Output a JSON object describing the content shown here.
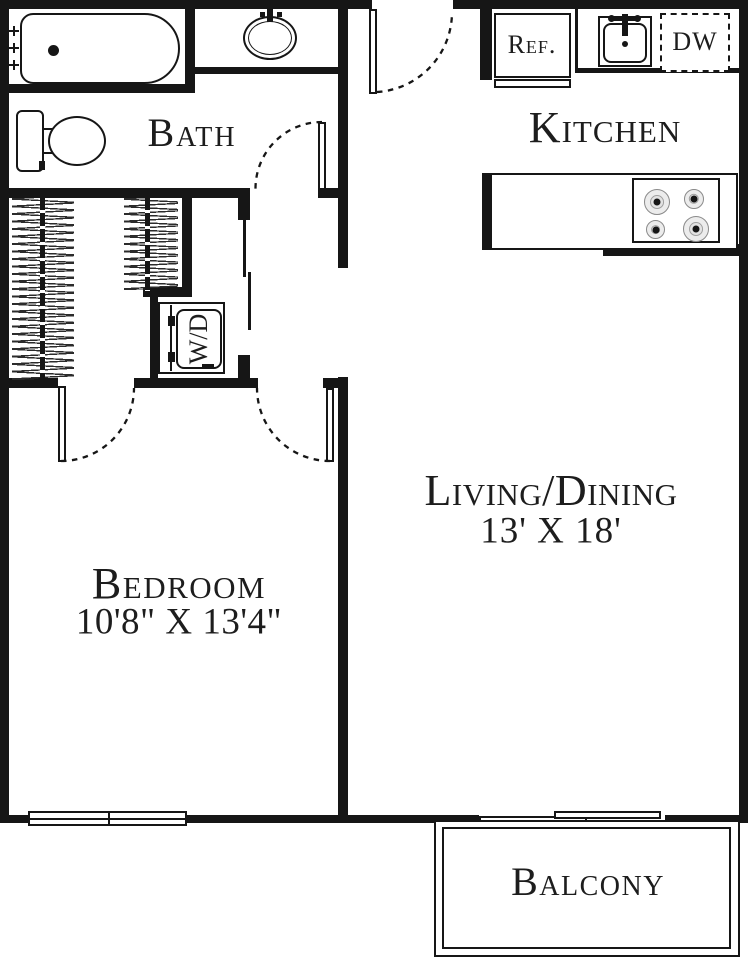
{
  "title": "One-bedroom apartment floor plan",
  "labels": {
    "bath": "Bath",
    "kitchen": "Kitchen",
    "living": "Living/Dining",
    "living_dims": "13' X 18'",
    "bedroom": "Bedroom",
    "bedroom_dims": "10'8\" X 13'4\"",
    "balcony": "Balcony",
    "refrigerator": "Ref.",
    "dishwasher": "DW",
    "washer_dryer": "W/D"
  },
  "fixtures": [
    "bathtub-icon",
    "tub-faucet-icon",
    "bathroom-sink-icon",
    "toilet-icon",
    "kitchen-sink-icon",
    "stove-burners-icon",
    "closet-hangers-icon",
    "door-swing-arc",
    "sliding-closet-door",
    "window",
    "sliding-glass-door",
    "balcony-rail"
  ],
  "colors": {
    "wall": "#161616",
    "background": "#ffffff",
    "text": "#1d1d1d"
  }
}
